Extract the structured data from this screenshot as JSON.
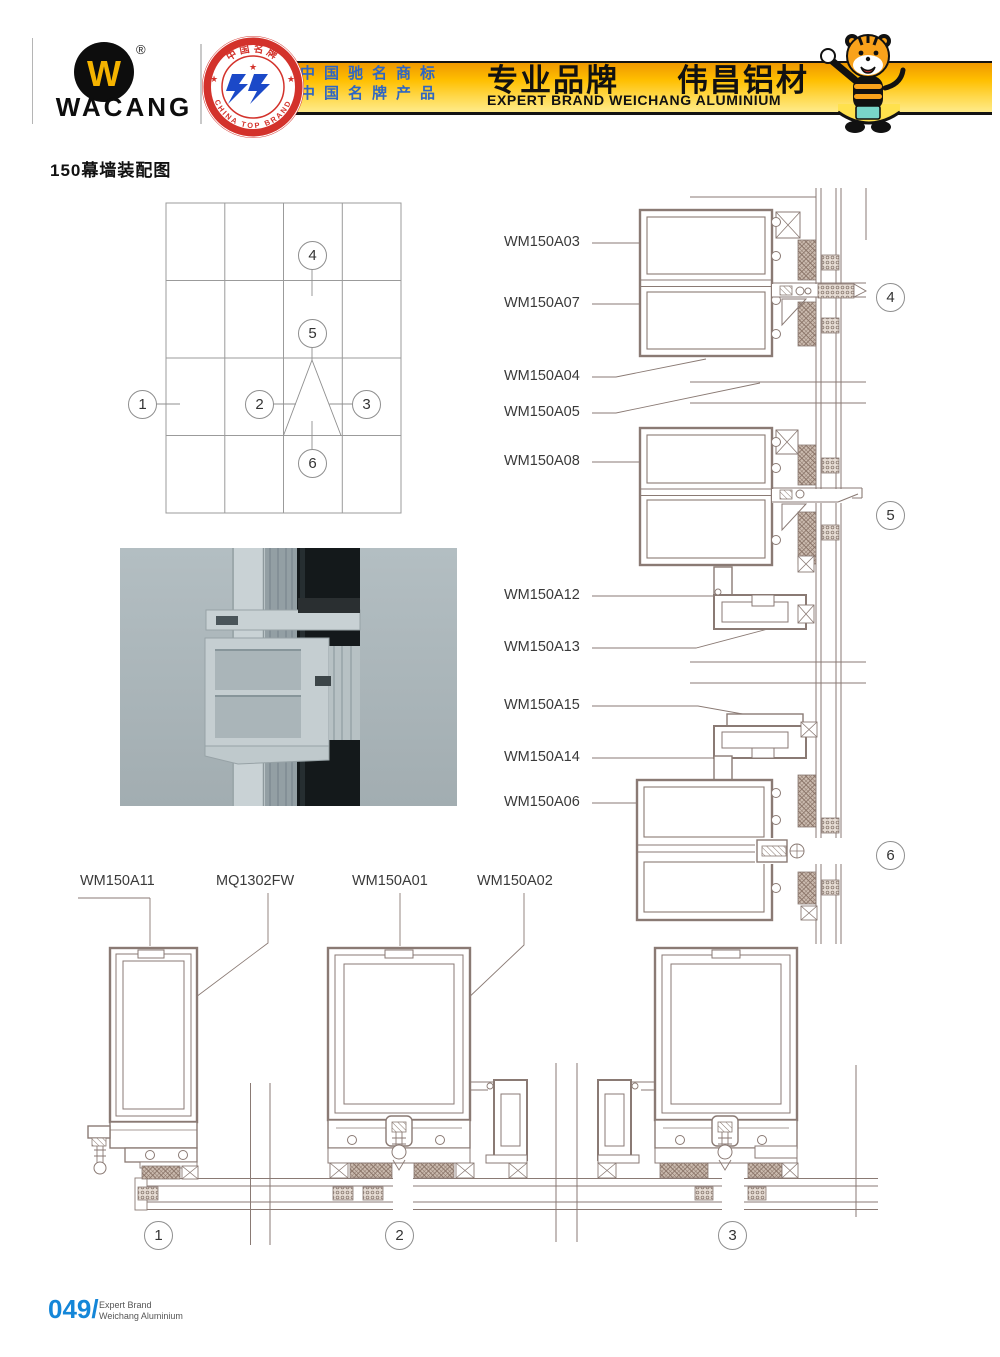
{
  "header": {
    "logo_brand": "WACANG",
    "logo_w": "W",
    "registered_mark": "®",
    "badge": {
      "arc_top": "中国名牌",
      "arc_bottom": "CHINA TOP BRAND",
      "star": "★"
    },
    "banner": {
      "slogan_line1": "中国驰名商标",
      "slogan_line2": "中国名牌产品",
      "brand_cn_left": "专业品牌",
      "brand_cn_right": "伟昌铝材",
      "brand_en": "EXPERT BRAND WEICHANG ALUMINIUM"
    }
  },
  "page": {
    "title": "150幕墙装配图"
  },
  "callouts": {
    "c1": "1",
    "c2": "2",
    "c3": "3",
    "c4": "4",
    "c5": "5",
    "c6": "6"
  },
  "part_labels": {
    "right": [
      "WM150A03",
      "WM150A07",
      "WM150A04",
      "WM150A05",
      "WM150A08",
      "WM150A12",
      "WM150A13",
      "WM150A15",
      "WM150A14",
      "WM150A06"
    ],
    "bottom": [
      "WM150A11",
      "MQ1302FW",
      "WM150A01",
      "WM150A02"
    ]
  },
  "footer": {
    "page_number": "049/",
    "brand_line1": "Expert Brand",
    "brand_line2": "Weichang Aluminium"
  },
  "colors": {
    "banner_orange": "#ef9800",
    "banner_yellow": "#ffd94d",
    "badge_red": "#d3322b",
    "slogan_blue": "#2e66c4",
    "footer_blue": "#1486d8",
    "drawing_line": "#8a7a74",
    "photo_background": "#a9b4b8"
  }
}
